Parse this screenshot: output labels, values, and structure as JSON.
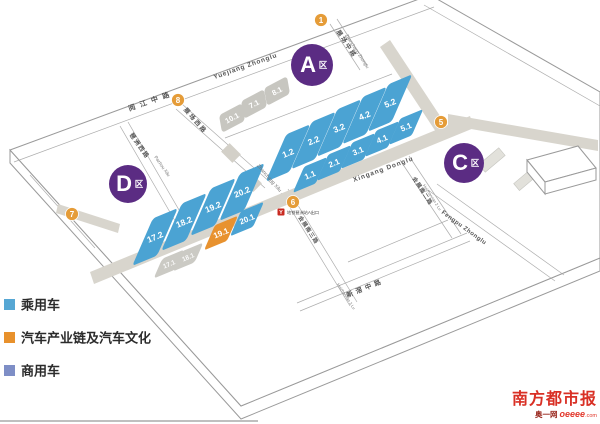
{
  "map": {
    "region_labels": {
      "zone_a_letter": "A",
      "zone_c_letter": "C",
      "zone_d_letter": "D",
      "zone_suffix": "区"
    },
    "markers": {
      "m1": "1",
      "m5": "5",
      "m6": "6",
      "m7": "7",
      "m8": "8"
    },
    "roads": {
      "yuejiang_cn": "阅江中路",
      "yuejiang_en": "Yuejiang Zhonglu",
      "zhanchang_zhong_cn": "展场中路",
      "zhanchang_zhong_en": "Zhanchang Zhonglu",
      "zhanchang_xi_cn": "展场西路",
      "zhanchang_xi_en": "Zhanchang Xilu",
      "pazhou_xi_cn": "琶洲西路",
      "pazhou_xi_en": "Pazhou Xilu",
      "xingang_en": "Xingang Donglu",
      "huizhannan3_cn": "会展南三路",
      "huizhannan3_en": "Huizhannan 3 Lu",
      "huizhannan2_cn": "会展南二路",
      "huizhannan2_en": "Huizhannan 2 Lu",
      "fengpu_en": "Fengpu Zhonglu",
      "xinjiao_cn": "新滘中路"
    },
    "metro_station_label": "地铁琶洲站A出口",
    "metro_icon_letter": "Y",
    "halls": {
      "a_upper": [
        "1.2",
        "2.2",
        "3.2",
        "4.2",
        "5.2"
      ],
      "a_lower": [
        "1.1",
        "2.1",
        "3.1",
        "4.1",
        "5.1"
      ],
      "a_grey": [
        "10.1",
        "7.1",
        "8.1"
      ],
      "d_upper": [
        "17.2",
        "18.2",
        "19.2",
        "20.2"
      ],
      "d_lower": [
        "19.1",
        "20.1"
      ],
      "d_grey": [
        "17.1",
        "18.1"
      ]
    }
  },
  "legend": {
    "items": [
      {
        "label": "乘用车",
        "color": "#56A7D4"
      },
      {
        "label": "汽车产业链及汽车文化",
        "color": "#E8912C"
      },
      {
        "label": "商用车",
        "color": "#7E8EC6"
      }
    ]
  },
  "logo": {
    "masthead": "南方都市报",
    "site_cn": "奥一网",
    "site_en": "oeeee",
    "site_tld": ".com"
  },
  "colors": {
    "hall_passenger_blue": "#4BA3D3",
    "hall_industry_orange": "#E8922F",
    "hall_grey": "#C7C6C0",
    "zone_badge_purple": "#5B2C83",
    "marker_orange": "#E59C38",
    "road_fill_grey": "#D8D5CD",
    "logo_red": "#D93025"
  }
}
